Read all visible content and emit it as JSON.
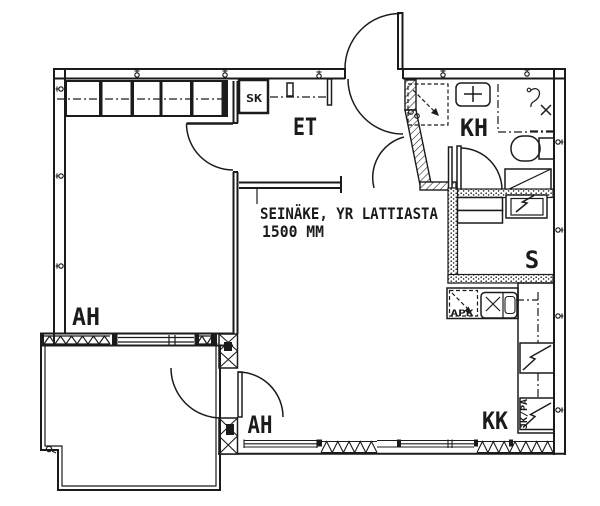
{
  "drawing": {
    "type": "apartment floor plan",
    "colors": {
      "ink": "#1b1b1b",
      "paper": "#ffffff"
    },
    "rooms": {
      "et": {
        "label": "ET"
      },
      "kh": {
        "label": "KH"
      },
      "sauna": {
        "label": "S"
      },
      "kk": {
        "label": "KK"
      },
      "ah_upper": {
        "label": "AH"
      },
      "ah_lower": {
        "label": "AH"
      },
      "sk": {
        "label": "SK"
      }
    },
    "appliances": {
      "dishwasher": {
        "label": "APK"
      },
      "fridge_freezer": {
        "label": "JK/PA"
      }
    },
    "annotation": {
      "line1": "SEINÄKE, YR LATTIASTA",
      "line2": "1500 MM"
    }
  }
}
